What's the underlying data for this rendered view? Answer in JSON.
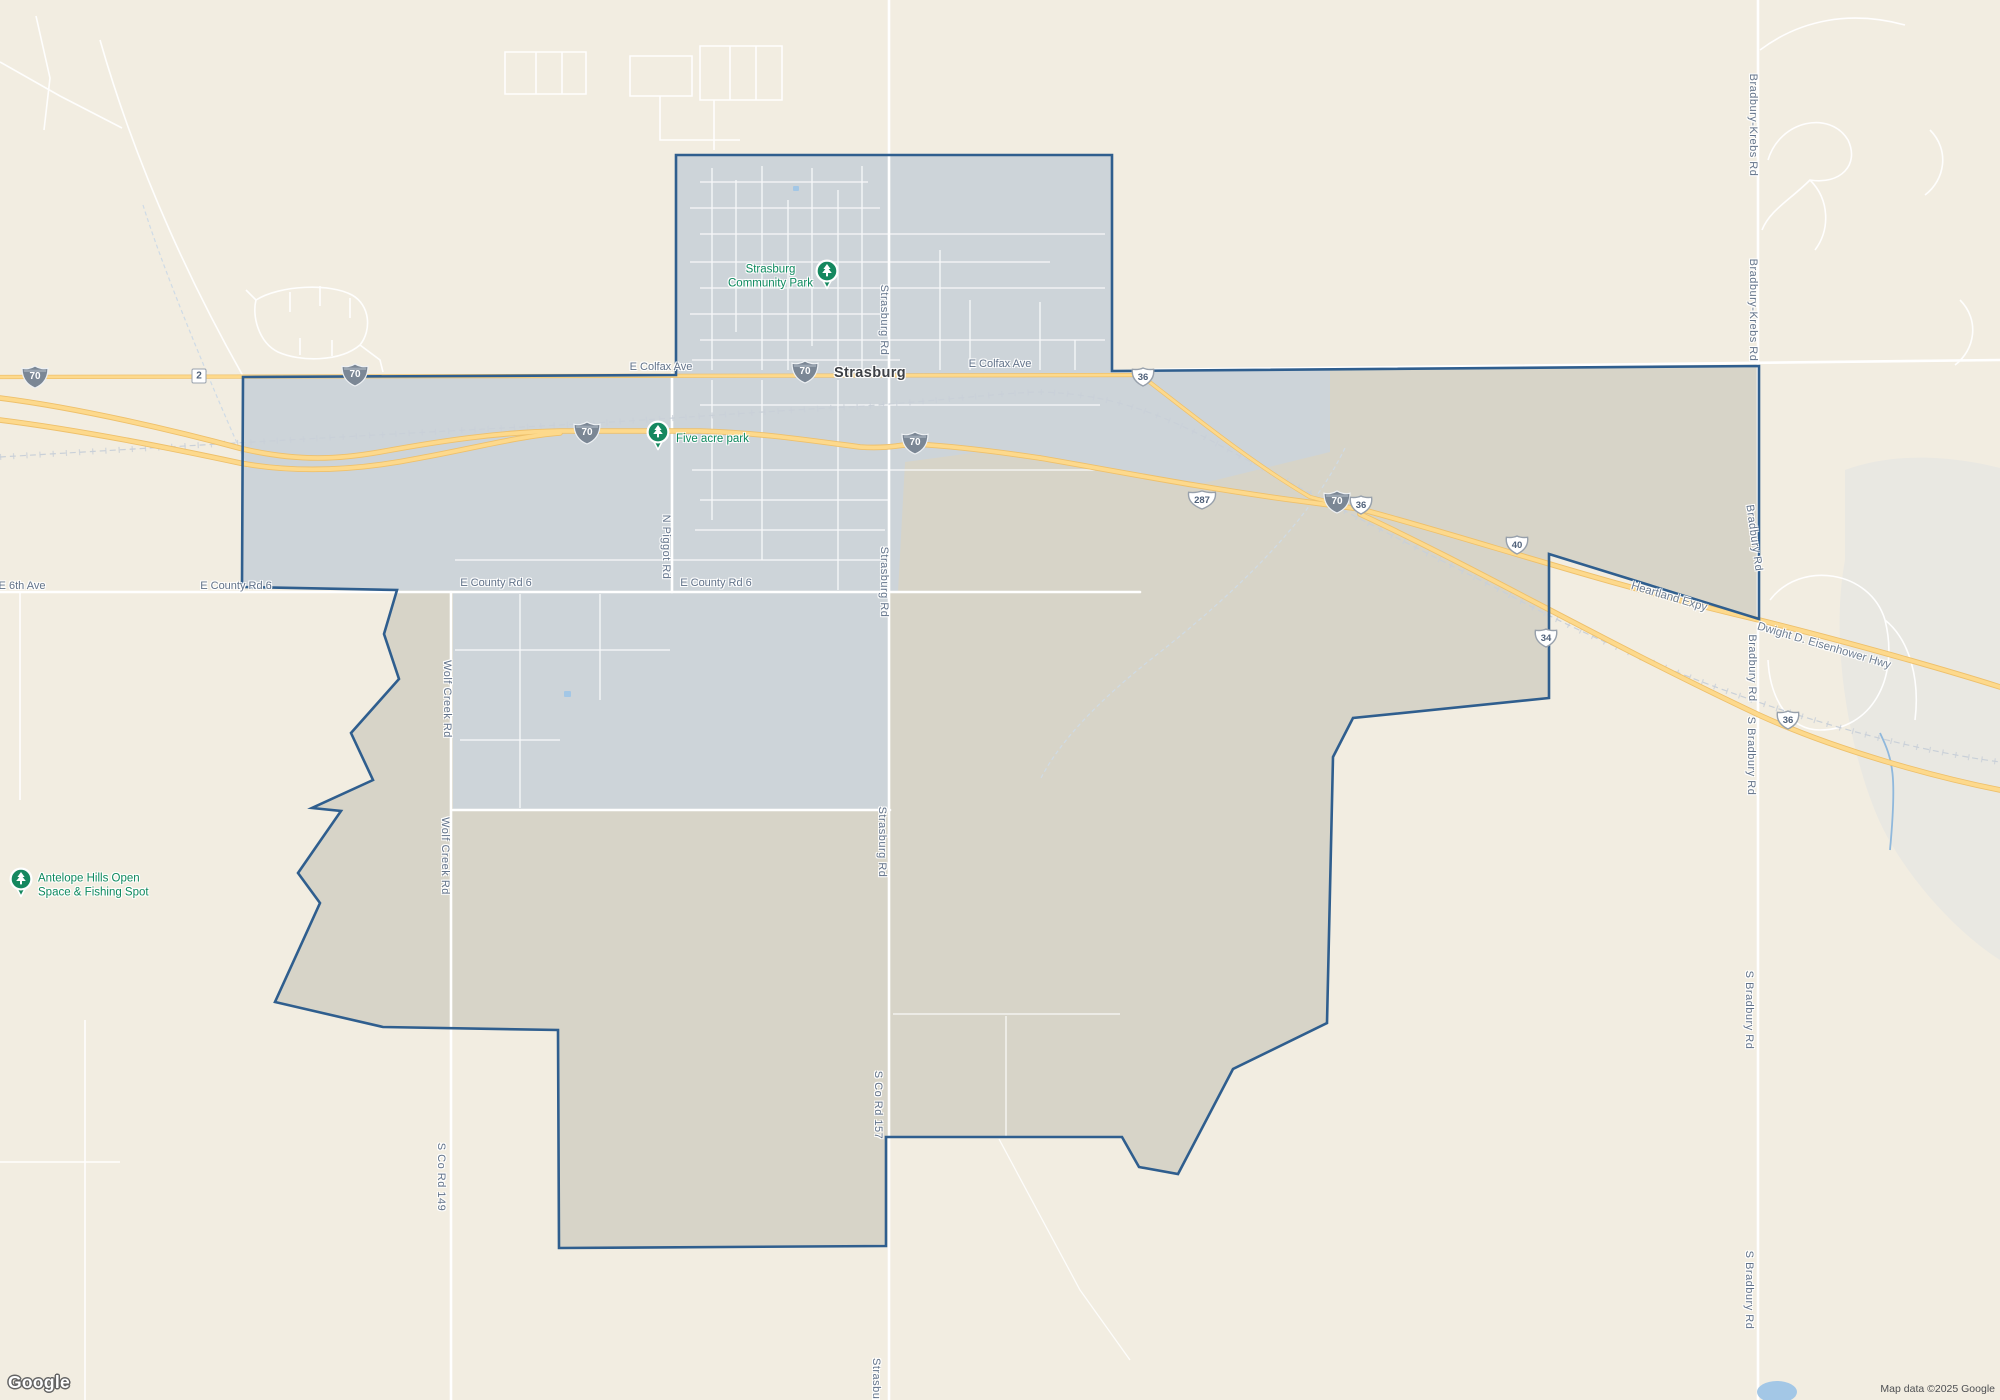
{
  "map": {
    "city_label": "Strasburg",
    "parks": [
      {
        "line1": "Strasburg",
        "line2": "Community Park"
      },
      {
        "line1": "Five acre park",
        "line2": ""
      },
      {
        "line1": "Antelope Hills Open",
        "line2": "Space & Fishing Spot"
      }
    ],
    "road_labels": [
      "E Colfax Ave",
      "E Colfax Ave",
      "E 6th Ave",
      "E County Rd 6",
      "E County Rd 6",
      "E County Rd 6",
      "Strasburg Rd",
      "Strasburg Rd",
      "Strasburg Rd",
      "S Co Rd 157",
      "Strasburg Rd",
      "N Piggot Rd",
      "Wolf Creek Rd",
      "Wolf Creek Rd",
      "S Co Rd 149",
      "Bradbury-Krebs Rd",
      "Bradbury-Krebs Rd",
      "Bradbury Rd",
      "Bradbury Rd",
      "S Bradbury Rd",
      "S Bradbury Rd",
      "S Bradbury Rd",
      "Heartland Expy",
      "Dwight D. Eisenhower Hwy"
    ],
    "shields": {
      "interstate": [
        "70",
        "70",
        "70",
        "70",
        "70",
        "70"
      ],
      "us": [
        "36",
        "287",
        "36",
        "40",
        "34",
        "36"
      ],
      "state": [
        "2"
      ]
    },
    "attribution": "Map data ©2025 Google",
    "logo": "Google",
    "colors": {
      "background": "#f2ede1",
      "boundary_stroke": "#2f5e8e",
      "region_fill": "#d7d4c8",
      "urban_fill": "#cdd4d9",
      "highway_yellow": "#fdd98c",
      "highway_casing": "#eec06b",
      "park_green": "#0e8a5f",
      "water_blue": "#a3c7e6"
    }
  }
}
